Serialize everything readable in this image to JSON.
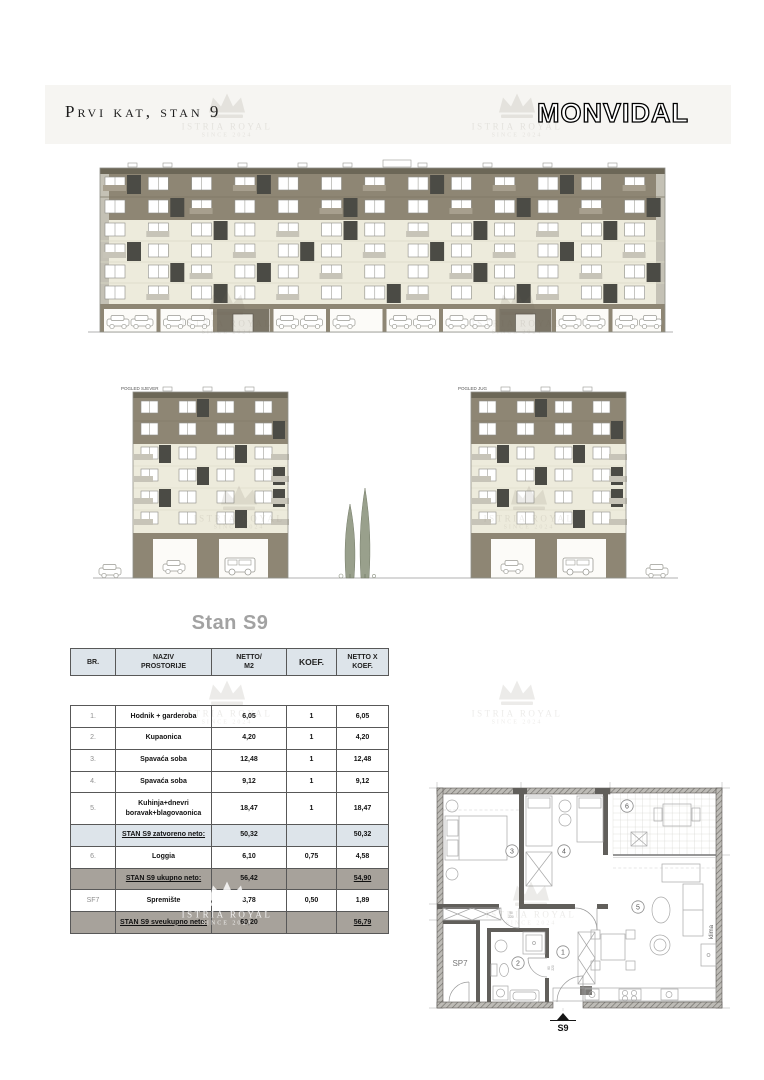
{
  "header": {
    "title": "Prvi kat, stan 9",
    "brand": "MONVIDAL"
  },
  "watermark": {
    "line1": "ISTRIA ROYAL",
    "line2": "SINCE 2024"
  },
  "elevations": {
    "left_label": "POGLED SJEVER",
    "right_label": "POGLED JUG"
  },
  "table": {
    "title": "Stan S9",
    "columns": [
      "BR.",
      "NAZIV\nPROSTORIJE",
      "NETTO/\nM2",
      "KOEF.",
      "NETTO X\nKOEF."
    ],
    "rows": [
      {
        "br": "1.",
        "name": "Hodnik + garderoba",
        "netto": "6,05",
        "koef": "1",
        "total": "6,05",
        "type": "data"
      },
      {
        "br": "2.",
        "name": "Kupaonica",
        "netto": "4,20",
        "koef": "1",
        "total": "4,20",
        "type": "data"
      },
      {
        "br": "3.",
        "name": "Spavaća soba",
        "netto": "12,48",
        "koef": "1",
        "total": "12,48",
        "type": "data"
      },
      {
        "br": "4.",
        "name": "Spavaća soba",
        "netto": "9,12",
        "koef": "1",
        "total": "9,12",
        "type": "data"
      },
      {
        "br": "5.",
        "name": "Kuhinja+dnevri boravak+blagovaonica",
        "netto": "18,47",
        "koef": "1",
        "total": "18,47",
        "type": "data"
      },
      {
        "br": "",
        "name": "STAN S9 zatvoreno neto:",
        "netto": "50,32",
        "koef": "",
        "total": "50,32",
        "type": "sub-blue"
      },
      {
        "br": "6.",
        "name": "Loggia",
        "netto": "6,10",
        "koef": "0,75",
        "total": "4,58",
        "type": "data"
      },
      {
        "br": "",
        "name": "STAN S9 ukupno neto:",
        "netto": "56,42",
        "koef": "",
        "total": "54,90",
        "type": "sub-gray"
      },
      {
        "br": "SF7",
        "name": "Spremište",
        "netto": "3,78",
        "koef": "0,50",
        "total": "1,89",
        "type": "data"
      },
      {
        "br": "",
        "name": "STAN S9 sveukupno neto:",
        "netto": "60,20",
        "koef": "",
        "total": "56,79",
        "type": "sub-gray"
      }
    ]
  },
  "floorplan": {
    "rooms": {
      "r1": "1",
      "r2": "2",
      "r3": "3",
      "r4": "4",
      "r5": "5",
      "r6": "6"
    },
    "storage_label": "SP7",
    "klima_label": "klima",
    "unit_label": "S9",
    "dims": {
      "d90": "90",
      "d220": "220",
      "d80": "80"
    }
  }
}
